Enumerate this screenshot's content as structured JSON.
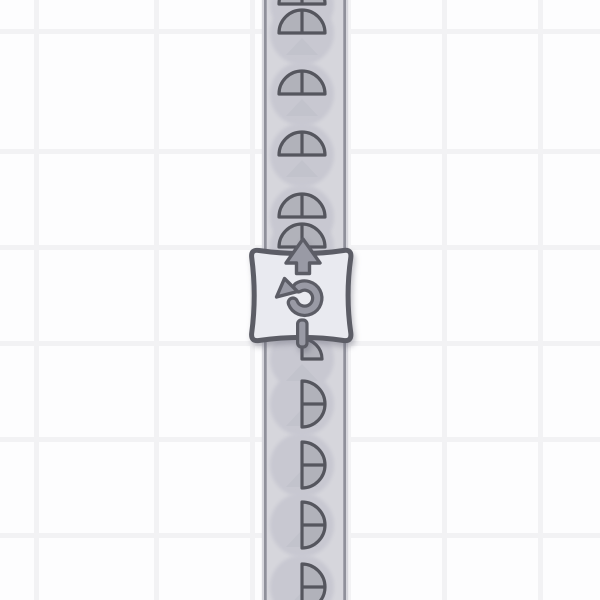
{
  "app": {
    "type": "factory-belt-puzzle",
    "view": "grid-world"
  },
  "grid": {
    "tile_color": "#fdfdfe",
    "line_color": "#f2f2f4",
    "pitch": 96,
    "line_width": 5,
    "offset_x": 58,
    "offset_y": 53
  },
  "belt": {
    "direction": "up",
    "x": 261.8,
    "width": 86.4,
    "fill": "#d6d6dc",
    "edge_color": "#8f909a",
    "edge_width": 2.7,
    "edge_inset": 2.2,
    "arrow_color": "#c2c3cc",
    "ghost_color": "#c8c8d1"
  },
  "items": {
    "center_x": 302,
    "radius": 23,
    "ghost_radius": 32,
    "fill": "#b1b2ba",
    "outline": "#55565e",
    "stroke_width": 3.2,
    "list": [
      {
        "type": "half-top",
        "y": 4
      },
      {
        "type": "half-top",
        "y": 33
      },
      {
        "type": "half-top",
        "y": 94
      },
      {
        "type": "half-top",
        "y": 155
      },
      {
        "type": "half-top",
        "y": 217
      },
      {
        "type": "half-top",
        "y": 247
      },
      {
        "type": "quarter-top-right",
        "y": 359,
        "radius": 20
      },
      {
        "type": "half-right",
        "y": 404
      },
      {
        "type": "half-right",
        "y": 465
      },
      {
        "type": "half-right",
        "y": 525
      },
      {
        "type": "half-right",
        "y": 587
      }
    ]
  },
  "marker": {
    "kind": "rotate-counterclockwise",
    "fill": "#e9eaf0",
    "outline": "#5c5d66",
    "icon_fill": "#999aa5",
    "shadow": "rgba(96,98,112,0.38)",
    "icons": [
      "up-arrow",
      "rotate-ccw",
      "pole"
    ]
  }
}
